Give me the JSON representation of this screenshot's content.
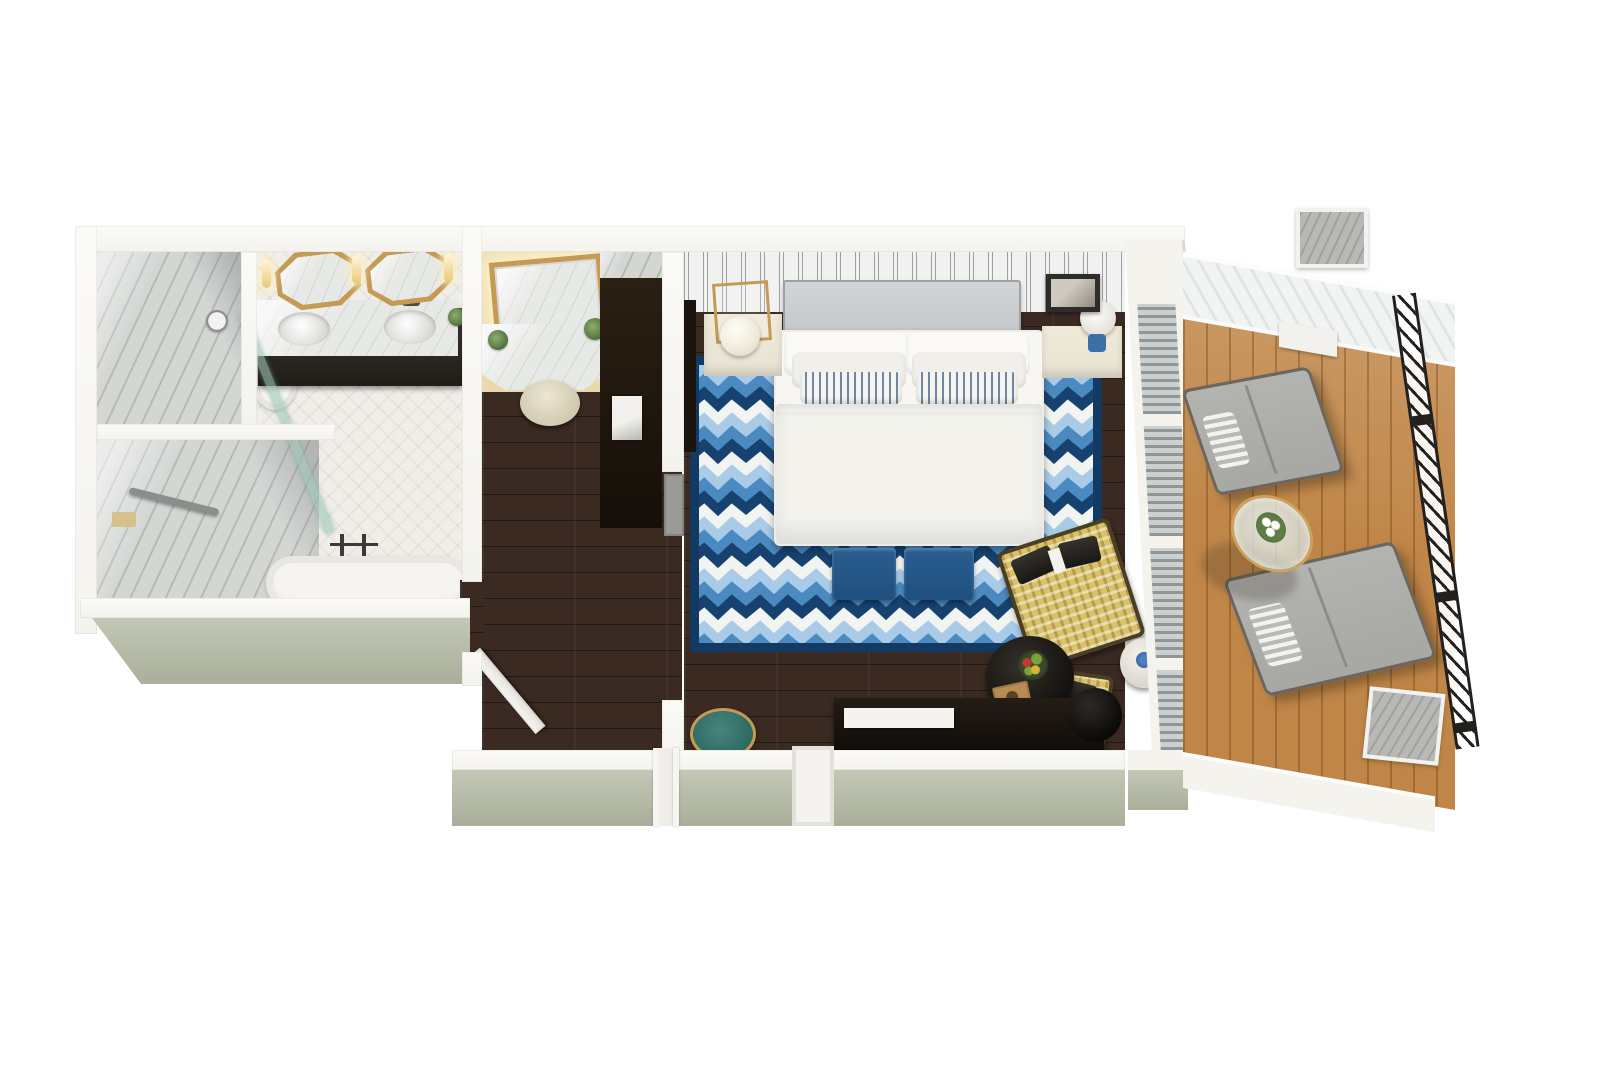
{
  "scene": {
    "type": "3d-floor-plan-render",
    "view": "top-down axonometric cutaway of a hotel guest suite",
    "rooms": [
      {
        "id": "bathroom",
        "label": "Bathroom",
        "floor": "white herringbone tile",
        "furniture": [
          "walk-in marble shower",
          "grab bar",
          "diagonal glass shower screen",
          "toilet",
          "double vanity with dark cabinet and two sinks",
          "two octagonal gold-framed mirrors",
          "three lit sconces",
          "wall magnifying mirror",
          "freestanding bathtub",
          "floor-mounted tub faucet",
          "small plant"
        ]
      },
      {
        "id": "dressing-area",
        "label": "Dressing area",
        "floor": "dark walnut plank",
        "furniture": [
          "lighted gold-framed makeup mirror",
          "marble makeup counter",
          "two potted plants",
          "round upholstered stool",
          "dark wardrobe closet",
          "gray marble shelf"
        ]
      },
      {
        "id": "hallway",
        "label": "Hallway",
        "floor": "dark walnut plank",
        "furniture": [
          "open white paneled door",
          "entry door recess"
        ]
      },
      {
        "id": "bedroom",
        "label": "Bedroom",
        "floor": "dark walnut plank",
        "walls": "white vertical shiplap paneling",
        "furniture": [
          "upholstered king bed with white duvet",
          "gray headboard",
          "four white pillows",
          "two blue striped accent pillows",
          "blue chevron area rug with navy border",
          "two navy foot-of-bed ottomans",
          "left nightstand with gold caged globe lamp",
          "right nightstand with blue table lamp",
          "framed wall art",
          "two yellow plaid armchairs with charcoal cushions",
          "round black coffee table with fruit bowl and wooden tray",
          "white drum side table with blue flowers",
          "black and white striped bench",
          "dark media console with white tray",
          "round dark planter",
          "gold and teal accent table"
        ]
      },
      {
        "id": "balcony",
        "label": "Balcony",
        "floor": "teak wood decking",
        "furniture": [
          "two gray chaise lounges with striped roll pillows",
          "round glass side table with white flowers",
          "black wrought-iron railing",
          "two concrete pillars",
          "white diagonal-plank roof band",
          "door threshold"
        ]
      }
    ]
  },
  "palette": {
    "bg": "#ffffff",
    "wall": "#f4f3ee",
    "wallSage": "#c3c7b5",
    "wallSageDark": "#a9af9b",
    "tileFloor": "#f0eee8",
    "marble": "#d3d6d3",
    "marbleLight": "#e7e9e6",
    "woodDark": "#3a2a22",
    "deck": "#c08648",
    "rugNavy": "#17426f",
    "rugBorder": "#123a63",
    "rugMid": "#4b8ac0",
    "rugLight": "#a9cbe7",
    "rugWhite": "#f2f4f1",
    "bedWhite": "#f7f6f2",
    "headboard": "#c2c6c8",
    "cream": "#e8e2d2",
    "gold": "#c49a55",
    "tealDeep": "#2e6b63",
    "benchNavy": "#1e4f7e",
    "chairYellow": "#d9c26a",
    "darkFurn": "#17120e",
    "charcoal": "#26231f",
    "lampBlue": "#3c6ea8",
    "grayFurn": "#a7a7a4",
    "warmWall": "#e9d9ac",
    "columnGray": "#b7b9b6"
  }
}
